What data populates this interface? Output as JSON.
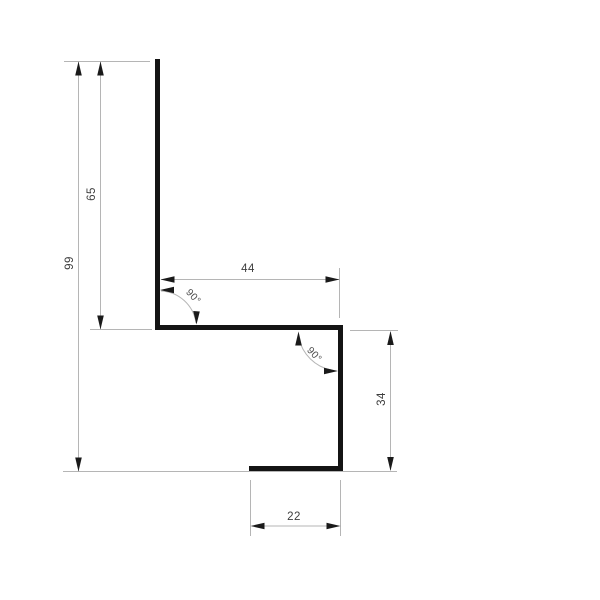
{
  "drawing": {
    "type": "technical-profile-cross-section",
    "labels": {
      "total_height": "99",
      "upper_height": "65",
      "shelf_width": "44",
      "lower_height": "34",
      "bottom_width": "22",
      "upper_angle": "90°",
      "lower_angle": "90°"
    },
    "colors": {
      "profile_line": "#141414",
      "dimension_line": "#b5b5b5",
      "arrowhead": "#1a1a1a",
      "label_text": "#3d3d3d",
      "background": "#ffffff"
    }
  }
}
